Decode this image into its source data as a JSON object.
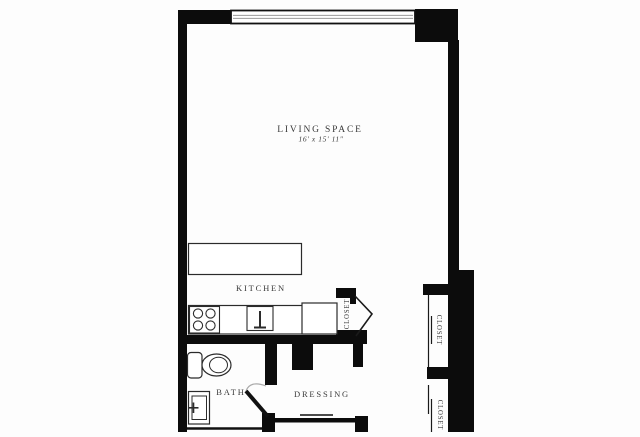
{
  "title": "Studio apartment floor plan",
  "colors": {
    "background": "#fdfdfd",
    "wall": "#0c0c0c",
    "fixture_stroke": "#2b2b2b",
    "door_arc": "#aaaaaa",
    "window_mullion": "#999999",
    "label_text": "#3a3a3a"
  },
  "rooms": {
    "living_space": {
      "label": "LIVING SPACE",
      "dimensions": "16' x 15' 11\""
    },
    "kitchen": {
      "label": "KITCHEN"
    },
    "bath": {
      "label": "BATH"
    },
    "dressing": {
      "label": "DRESSING"
    },
    "closet_kitchen": {
      "label": "CLOSET"
    },
    "closet_upper_right": {
      "label": "CLOSET"
    },
    "closet_lower_right": {
      "label": "CLOSET"
    }
  },
  "fixtures": [
    "window",
    "kitchen-island",
    "stove",
    "kitchen-sink",
    "refrigerator",
    "toilet",
    "bathroom-sink",
    "hinged-door",
    "bifold-door",
    "sliding-doors"
  ]
}
